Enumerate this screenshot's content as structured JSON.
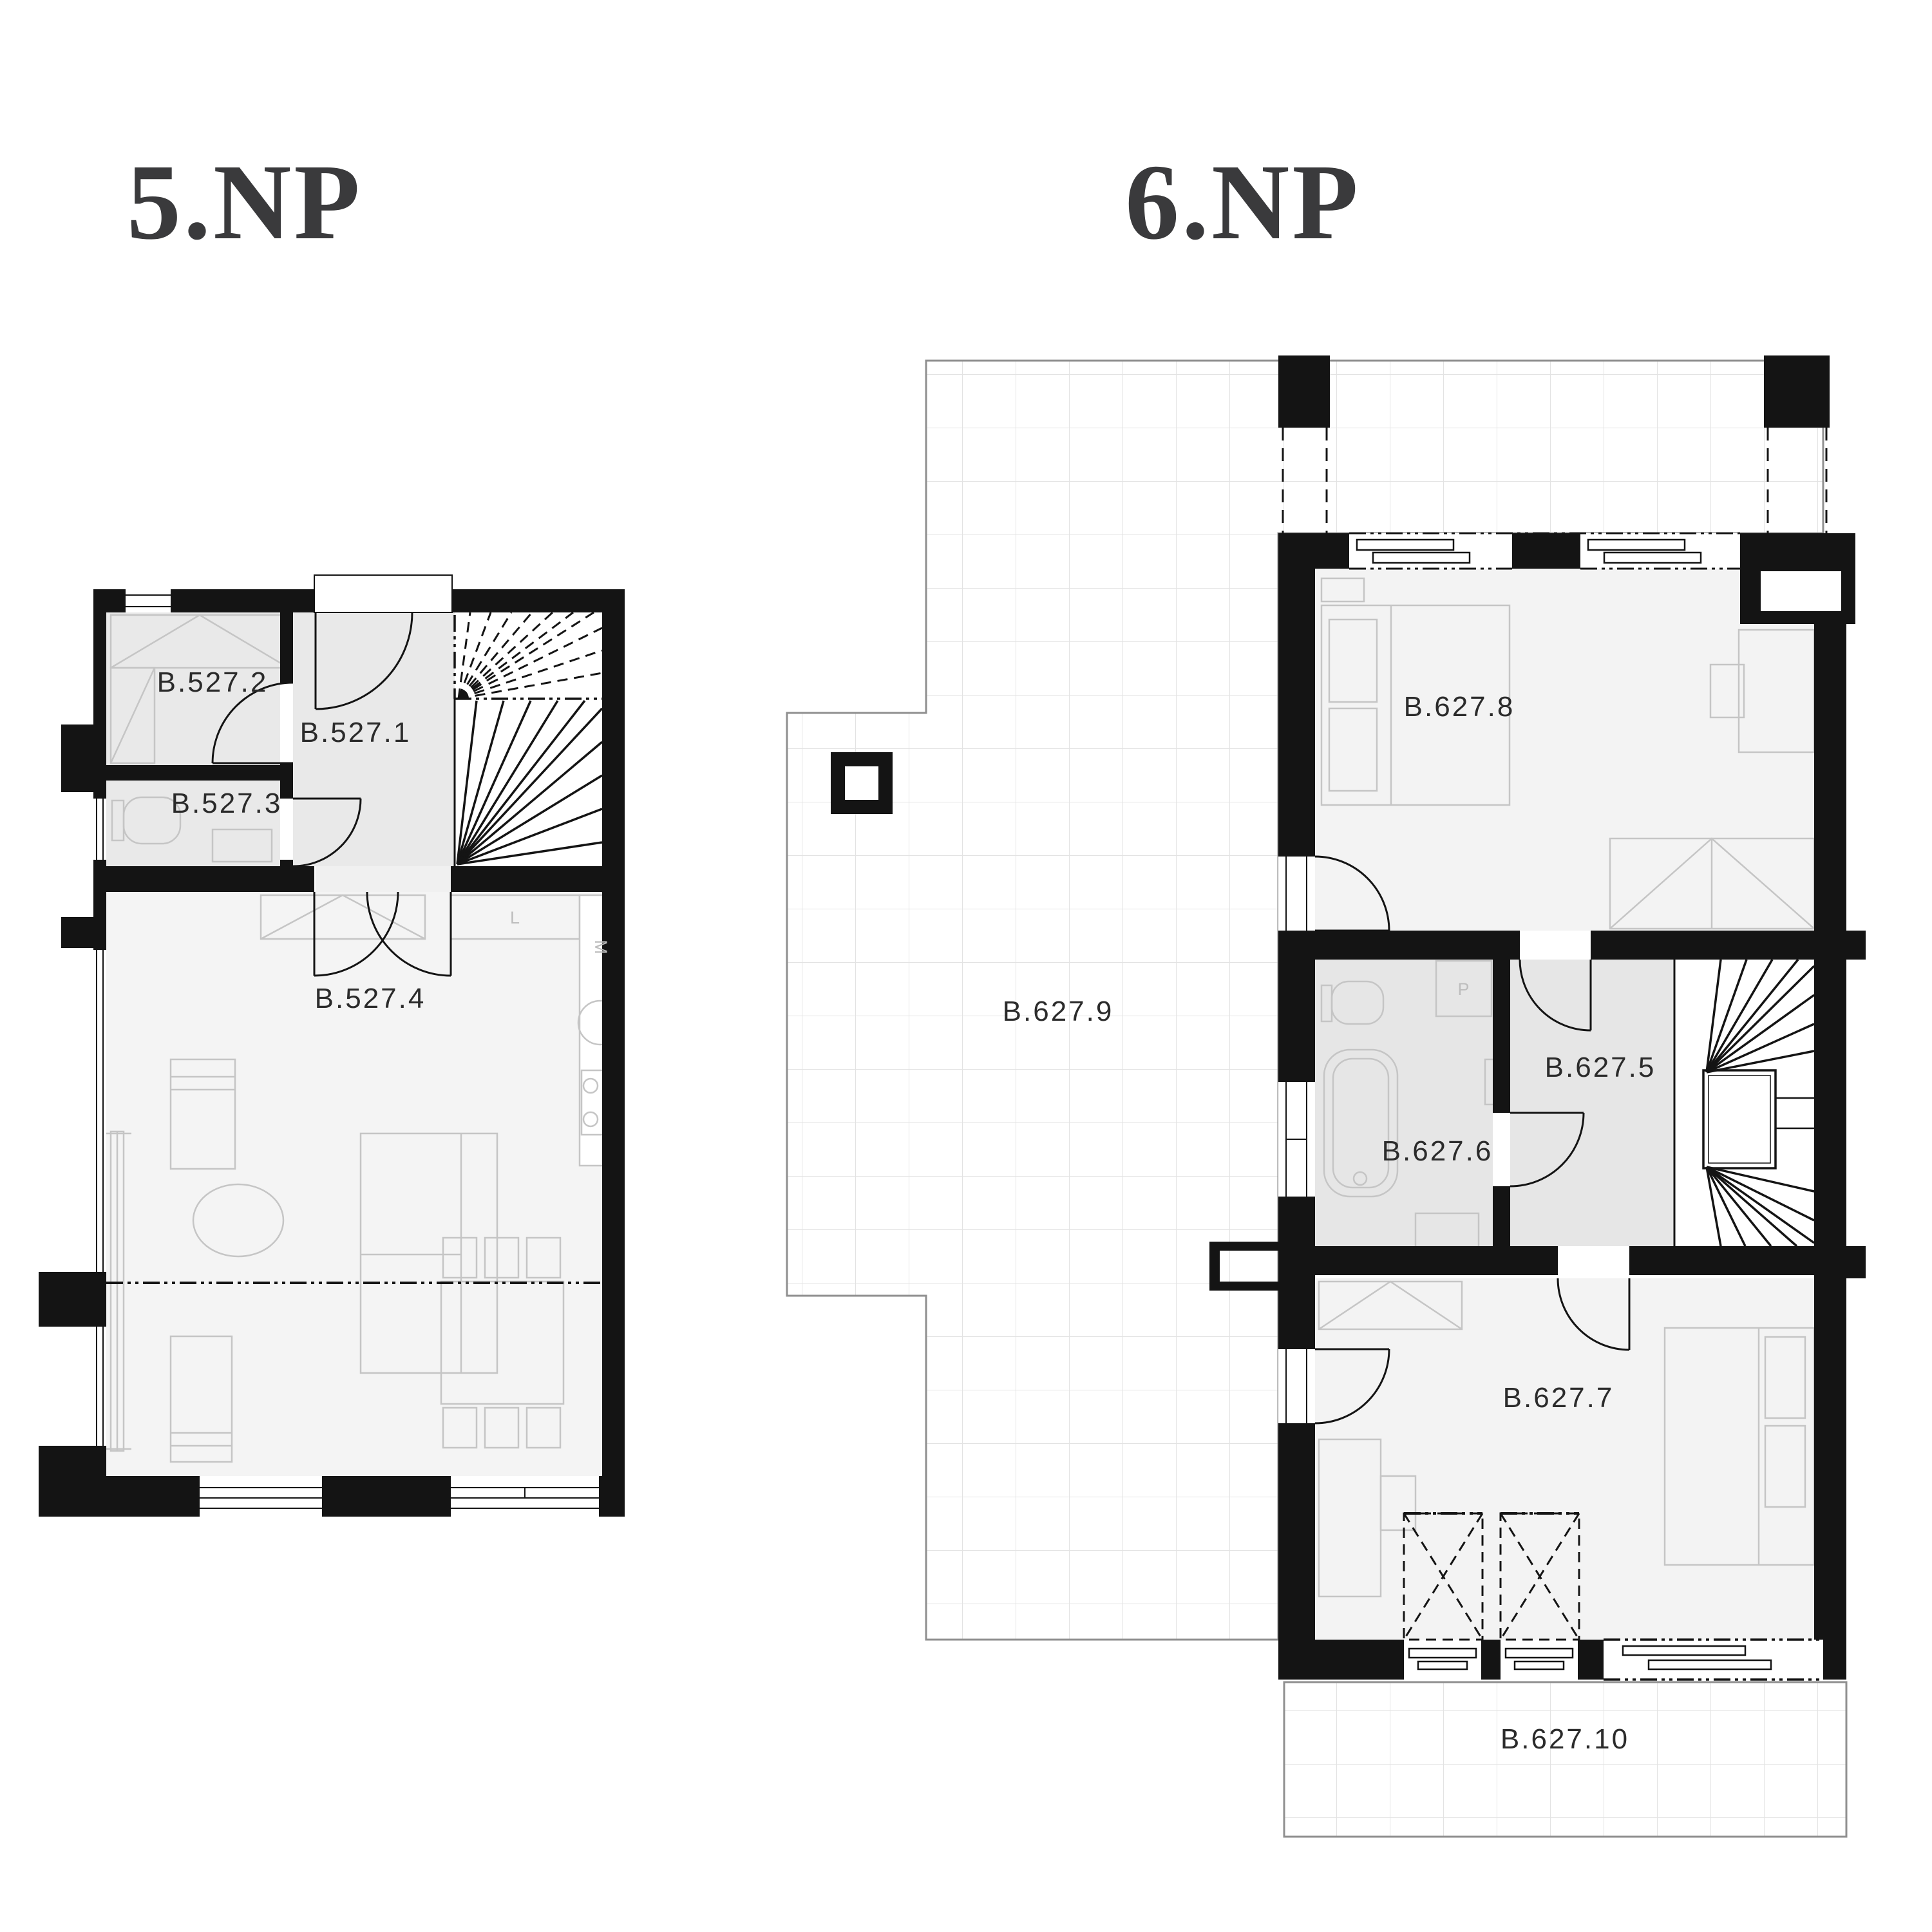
{
  "document": {
    "type": "floor-plan",
    "background": "#ffffff"
  },
  "floors": [
    {
      "id": "5np",
      "title": "5.NP",
      "rooms": [
        {
          "id": "b527-1",
          "label": "B.527.1"
        },
        {
          "id": "b527-2",
          "label": "B.527.2"
        },
        {
          "id": "b527-3",
          "label": "B.527.3"
        },
        {
          "id": "b527-4",
          "label": "B.527.4"
        }
      ]
    },
    {
      "id": "6np",
      "title": "6.NP",
      "rooms": [
        {
          "id": "b627-5",
          "label": "B.627.5"
        },
        {
          "id": "b627-6",
          "label": "B.627.6"
        },
        {
          "id": "b627-7",
          "label": "B.627.7"
        },
        {
          "id": "b627-8",
          "label": "B.627.8"
        },
        {
          "id": "b627-9",
          "label": "B.627.9"
        },
        {
          "id": "b627-10",
          "label": "B.627.10"
        }
      ]
    }
  ],
  "appliance_tags": {
    "fridge": "L",
    "dishwasher": "M",
    "washing_machine": "P"
  },
  "colors": {
    "wall": "#141414",
    "room_fill_light": "#f3f3f3",
    "room_fill_mid": "#e9e9e9",
    "bath_fill": "#e6e6e6",
    "furniture_stroke": "#c5c5c5",
    "grid_line": "#e3e3e3",
    "terrace_border": "#8f8f8f",
    "label_text": "#2b2b2b",
    "title_text": "#3a3a3c",
    "tag_text": "#bdbdbd"
  }
}
